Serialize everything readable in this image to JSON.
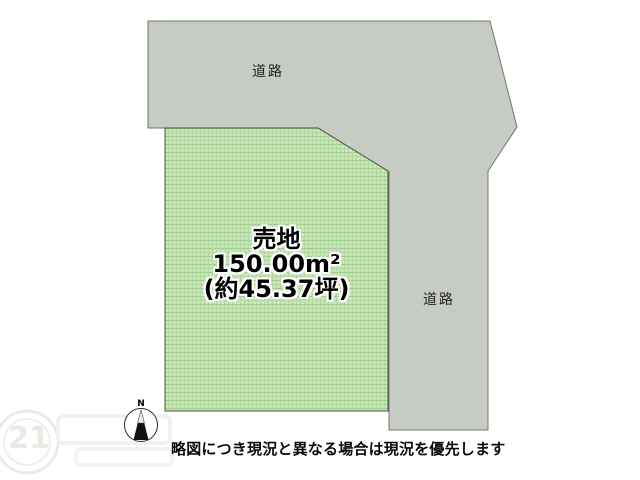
{
  "map": {
    "road_top_label": "道路",
    "road_right_label": "道路",
    "plot": {
      "title": "売地",
      "area_metric": "150.00m²",
      "area_tsubo": "(約45.37坪)"
    },
    "compass_north": "N",
    "watermark_text": "21",
    "disclaimer": "略図につき現況と異なる場合は現況を優先します"
  },
  "colors": {
    "road_fill": "#c6cbc3",
    "road_border": "#717770",
    "plot_fill": "#cbe5bb",
    "plot_grid": "#b2d8a2",
    "plot_grid_strong": "#9dc98c",
    "plot_border": "#45543b",
    "compass_ring": "#2b2b2b",
    "needle_dark": "#111111",
    "needle_light": "#ededed",
    "watermark_line": "#ececе8"
  }
}
